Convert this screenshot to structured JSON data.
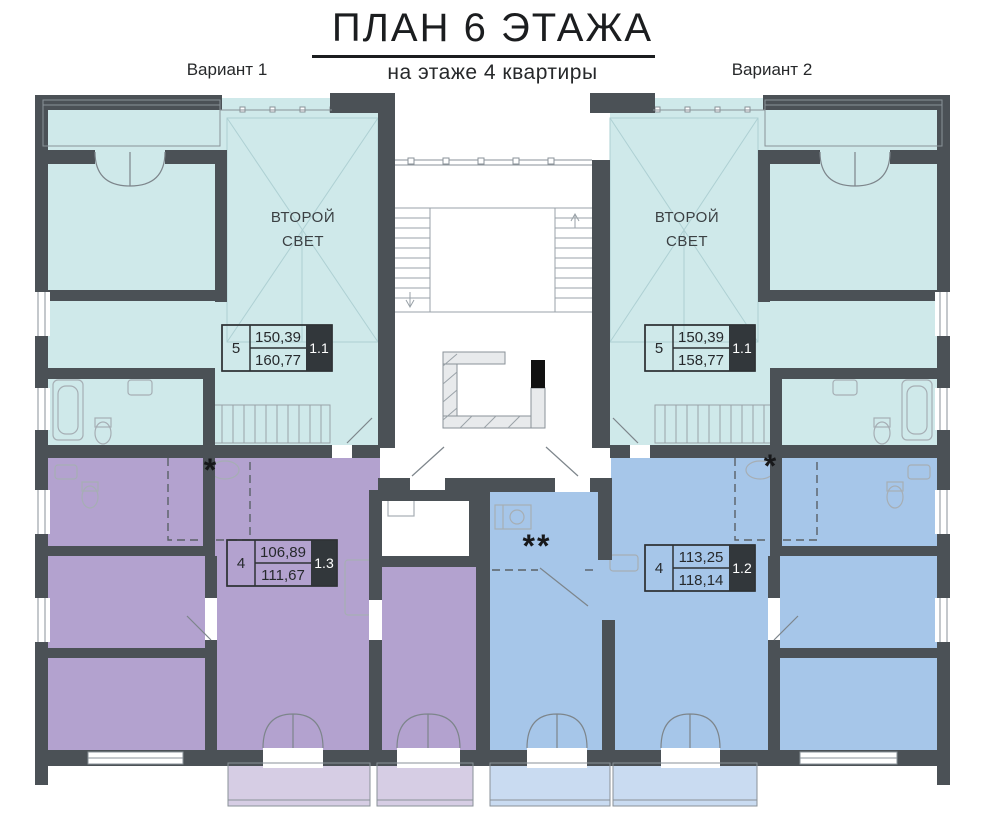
{
  "header": {
    "title": "ПЛАН 6 ЭТАЖА",
    "subtitle": "на этаже 4 квартиры",
    "variant1": "Вариант 1",
    "variant2": "Вариант 2"
  },
  "labels": {
    "second_light_line1": "ВТОРОЙ",
    "second_light_line2": "СВЕТ",
    "star": "*",
    "double_star": "**"
  },
  "apartments": {
    "left_top": {
      "rooms": "5",
      "area_main": "150,39",
      "area_total": "160,77",
      "unit": "1.1"
    },
    "right_top": {
      "rooms": "5",
      "area_main": "150,39",
      "area_total": "158,77",
      "unit": "1.1"
    },
    "left_bottom": {
      "rooms": "4",
      "area_main": "106,89",
      "area_total": "111,67",
      "unit": "1.3"
    },
    "right_bottom": {
      "rooms": "4",
      "area_main": "113,25",
      "area_total": "118,14",
      "unit": "1.2"
    }
  },
  "colors": {
    "teal": "#cfe9ea",
    "purple": "#b3a2cf",
    "blue": "#a6c6e9",
    "purple_light": "#d6cde4",
    "blue_light": "#c9dbf1",
    "wall": "#4b5156",
    "unit_badge": "#32373b"
  }
}
